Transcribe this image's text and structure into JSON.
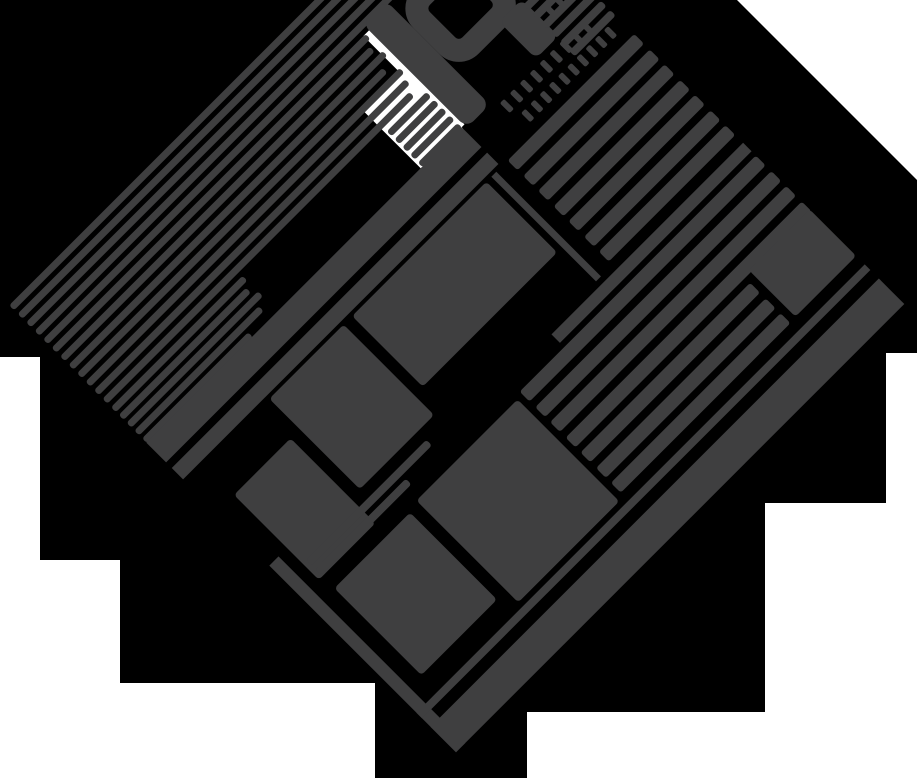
{
  "title": "Rotated page-skeleton illustration",
  "colors": {
    "background": "#ffffff",
    "backdrop": "#000000",
    "ink": "#3f3f40",
    "paper_patch": "#ffffff"
  },
  "canvas": {
    "width": 917,
    "height": 778
  },
  "backdrop": {
    "points": "0,0 737,0 917,180 917,353 886,353 886,503 765,503 765,712 527,712 527,778 375,778 375,683 120,683 120,560 40,560 40,357 0,357"
  },
  "page": {
    "size": 634,
    "left": 139,
    "top": -13,
    "rotation_deg": -45
  },
  "glyph": {
    "letter": "h"
  },
  "elements": [
    {
      "name": "white-patch-behind-lines",
      "type": "rect",
      "x": 388,
      "y": 116,
      "w": 58,
      "h": 82,
      "fill": "#ffffff"
    },
    {
      "name": "white-stem-channel",
      "type": "rect",
      "x": 441,
      "y": 62,
      "w": 9,
      "h": 134,
      "fill": "#ffffff"
    },
    {
      "name": "top-paragraph-lines-1",
      "type": "lines",
      "x": 0,
      "y": 2,
      "period": 12,
      "lh": 7,
      "widths": [
        524,
        516,
        528,
        510,
        520
      ]
    },
    {
      "name": "top-paragraph-lines-2",
      "type": "lines",
      "x": 0,
      "y": 62,
      "period": 12,
      "lh": 7,
      "widths": [
        444,
        438,
        444,
        432,
        444,
        440,
        434
      ]
    },
    {
      "name": "top-paragraph-lines-3",
      "type": "lines",
      "x": 0,
      "y": 146,
      "period": 11,
      "lh": 7,
      "widths": [
        186,
        180,
        186,
        176,
        150
      ]
    },
    {
      "name": "top-paragraph-lines-4",
      "type": "lines",
      "x": 390,
      "y": 146,
      "period": 11,
      "lh": 7,
      "widths": [
        56,
        56,
        56,
        56,
        56
      ]
    },
    {
      "name": "letter-h-stem",
      "type": "rect",
      "x": 449,
      "y": 52,
      "w": 33,
      "h": 148,
      "r": 10
    },
    {
      "name": "letter-h-bowl",
      "type": "ring",
      "x": 482,
      "y": 64,
      "w": 97,
      "h": 92,
      "bw": 23,
      "r": 28
    },
    {
      "name": "letter-h-leg",
      "type": "rect",
      "x": 547,
      "y": 148,
      "w": 32,
      "h": 52,
      "r": 8
    },
    {
      "name": "tiny-text-row-1",
      "type": "dashes",
      "x": 588,
      "y": 168,
      "count": 4,
      "w": 6,
      "h": 14,
      "gap": 7
    },
    {
      "name": "tiny-text-row-2",
      "type": "dashes",
      "x": 490,
      "y": 206,
      "count": 9,
      "w": 6,
      "h": 14,
      "gap": 8
    },
    {
      "name": "tiny-text-row-3",
      "type": "dashes",
      "x": 498,
      "y": 228,
      "count": 10,
      "w": 6,
      "h": 13,
      "gap": 7
    },
    {
      "name": "section-band-1",
      "type": "rect",
      "x": 0,
      "y": 196,
      "w": 446,
      "h": 28
    },
    {
      "name": "section-band-2",
      "type": "rect",
      "x": 0,
      "y": 232,
      "w": 446,
      "h": 16
    },
    {
      "name": "topright-small-rows",
      "type": "rows",
      "x": 576,
      "y": 140,
      "period": 13,
      "lh": 8,
      "count": 7,
      "w": 58
    },
    {
      "name": "right-list-rows-upper",
      "type": "rows",
      "x": 455,
      "y": 252,
      "period": 21.5,
      "lh": 14,
      "count": 7,
      "w": 179
    },
    {
      "name": "vertical-rule",
      "type": "rect",
      "x": 432,
      "y": 252,
      "w": 7,
      "h": 148
    },
    {
      "name": "image-block-1",
      "type": "rect",
      "x": 118,
      "y": 252,
      "w": 105,
      "h": 128,
      "r": 4
    },
    {
      "name": "image-block-2",
      "type": "rect",
      "x": 235,
      "y": 252,
      "w": 190,
      "h": 100,
      "r": 4
    },
    {
      "name": "image-block-3",
      "type": "rect",
      "x": 25,
      "y": 295,
      "w": 80,
      "h": 120,
      "r": 4
    },
    {
      "name": "caption-lines",
      "type": "lines",
      "x": 30,
      "y": 392,
      "period": 13,
      "lh": 8,
      "widths": [
        170,
        128
      ]
    },
    {
      "name": "horizontal-rule-2",
      "type": "rect",
      "x": 363,
      "y": 406,
      "w": 271,
      "h": 12
    },
    {
      "name": "right-list-rows-lower-a",
      "type": "rows",
      "x": 300,
      "y": 424,
      "period": 21.5,
      "lh": 14,
      "count": 4,
      "w": 334
    },
    {
      "name": "right-list-rows-lower-b",
      "type": "rows",
      "x": 300,
      "y": 510,
      "period": 21.5,
      "lh": 14,
      "count": 3,
      "w": 240
    },
    {
      "name": "image-block-4",
      "type": "rect",
      "x": 30,
      "y": 432,
      "w": 107,
      "h": 123,
      "r": 4
    },
    {
      "name": "image-block-5",
      "type": "rect",
      "x": 150,
      "y": 428,
      "w": 143,
      "h": 144,
      "r": 4
    },
    {
      "name": "image-block-6",
      "type": "rect",
      "x": 548,
      "y": 500,
      "w": 86,
      "h": 66,
      "r": 4
    },
    {
      "name": "left-edge-bar",
      "type": "rect",
      "x": 0,
      "y": 370,
      "w": 13,
      "h": 264
    },
    {
      "name": "footer-rule",
      "type": "rect",
      "x": 0,
      "y": 578,
      "w": 634,
      "h": 8
    },
    {
      "name": "footer-band",
      "type": "rect",
      "x": 0,
      "y": 598,
      "w": 634,
      "h": 36
    }
  ]
}
